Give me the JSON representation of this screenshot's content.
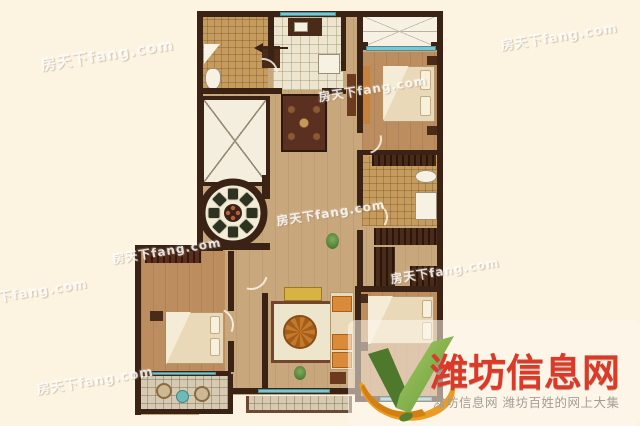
{
  "page": {
    "background_color": "#fcf4e1"
  },
  "watermark": {
    "text": "房天下fang.com"
  },
  "logo": {
    "title": "潍坊信息网",
    "subtitle": "潍坊信息网 潍坊百姓的网上大集",
    "title_color": "#dc3a28",
    "subtitle_color": "#a39e94",
    "icon": "v-leaf-logo",
    "icon_colors": {
      "green_dark": "#4e782c",
      "green_light": "#a6cc66",
      "orange": "#ec9c22"
    }
  },
  "floorplan": {
    "colors": {
      "wall": "#3a2315",
      "window_glass": "#7cc6cf",
      "wood_floor": "#c9a77d",
      "bedroom_floor": "#bb8d5f",
      "bathroom_tile": "#c59c5e",
      "kitchen_tile": "#ece5d0",
      "balcony_tile": "#d6cbb2",
      "wardrobe": "#4a2a18"
    },
    "elements": [
      "bathroom",
      "kitchen",
      "entry-hall",
      "elevator-shaft",
      "round-dining-table",
      "master-bedroom",
      "second-bathroom",
      "walk-in-closet",
      "second-bedroom",
      "living-room",
      "third-bedroom",
      "balcony",
      "bay-window"
    ]
  }
}
